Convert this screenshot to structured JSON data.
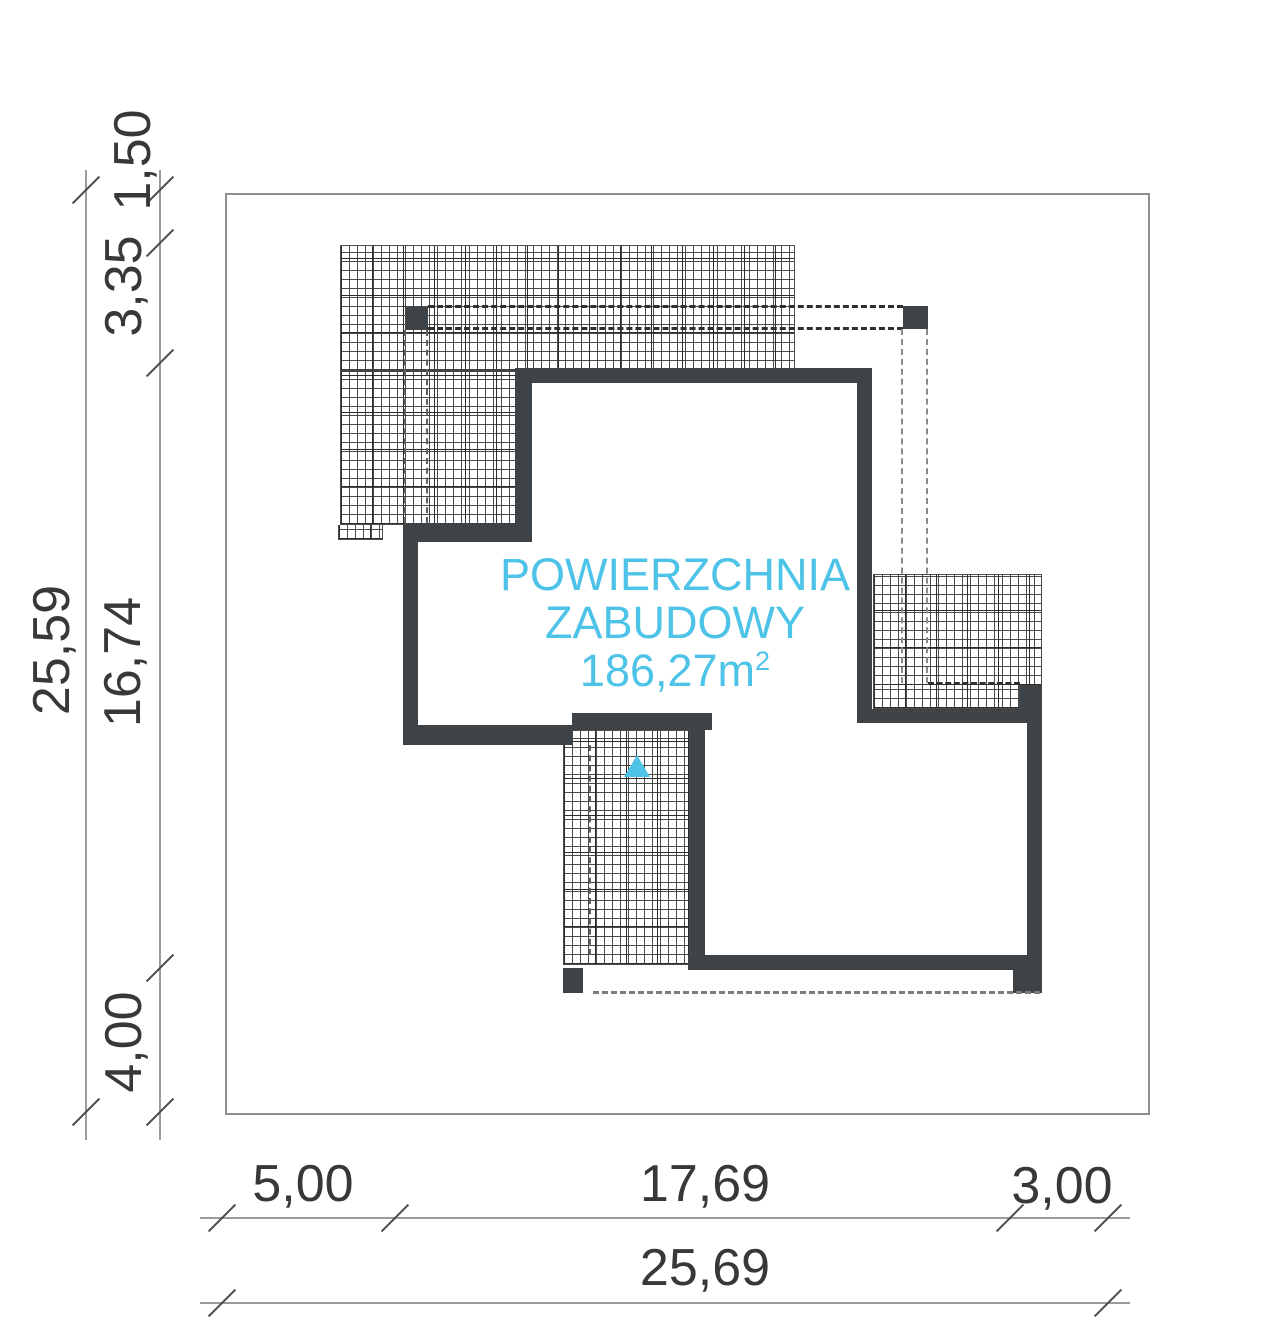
{
  "drawing": {
    "type": "building-footprint-site-plan",
    "area_label": {
      "line1": "POWIERZCHNIA",
      "line2": "ZABUDOWY",
      "value": "186,27m",
      "sup": "2"
    },
    "dimensions": {
      "left": {
        "total": "25,59",
        "segments": [
          "1,50",
          "3,35",
          "16,74",
          "4,00"
        ]
      },
      "bottom": {
        "total": "25,69",
        "segments": [
          "5,00",
          "17,69",
          "3,00"
        ]
      }
    },
    "colors": {
      "accent": "#4ec3e8",
      "wall": "#3e4347",
      "dim_line": "#9b9b9b",
      "dim_text": "#383838",
      "plot_border": "#8e8e8e"
    }
  }
}
